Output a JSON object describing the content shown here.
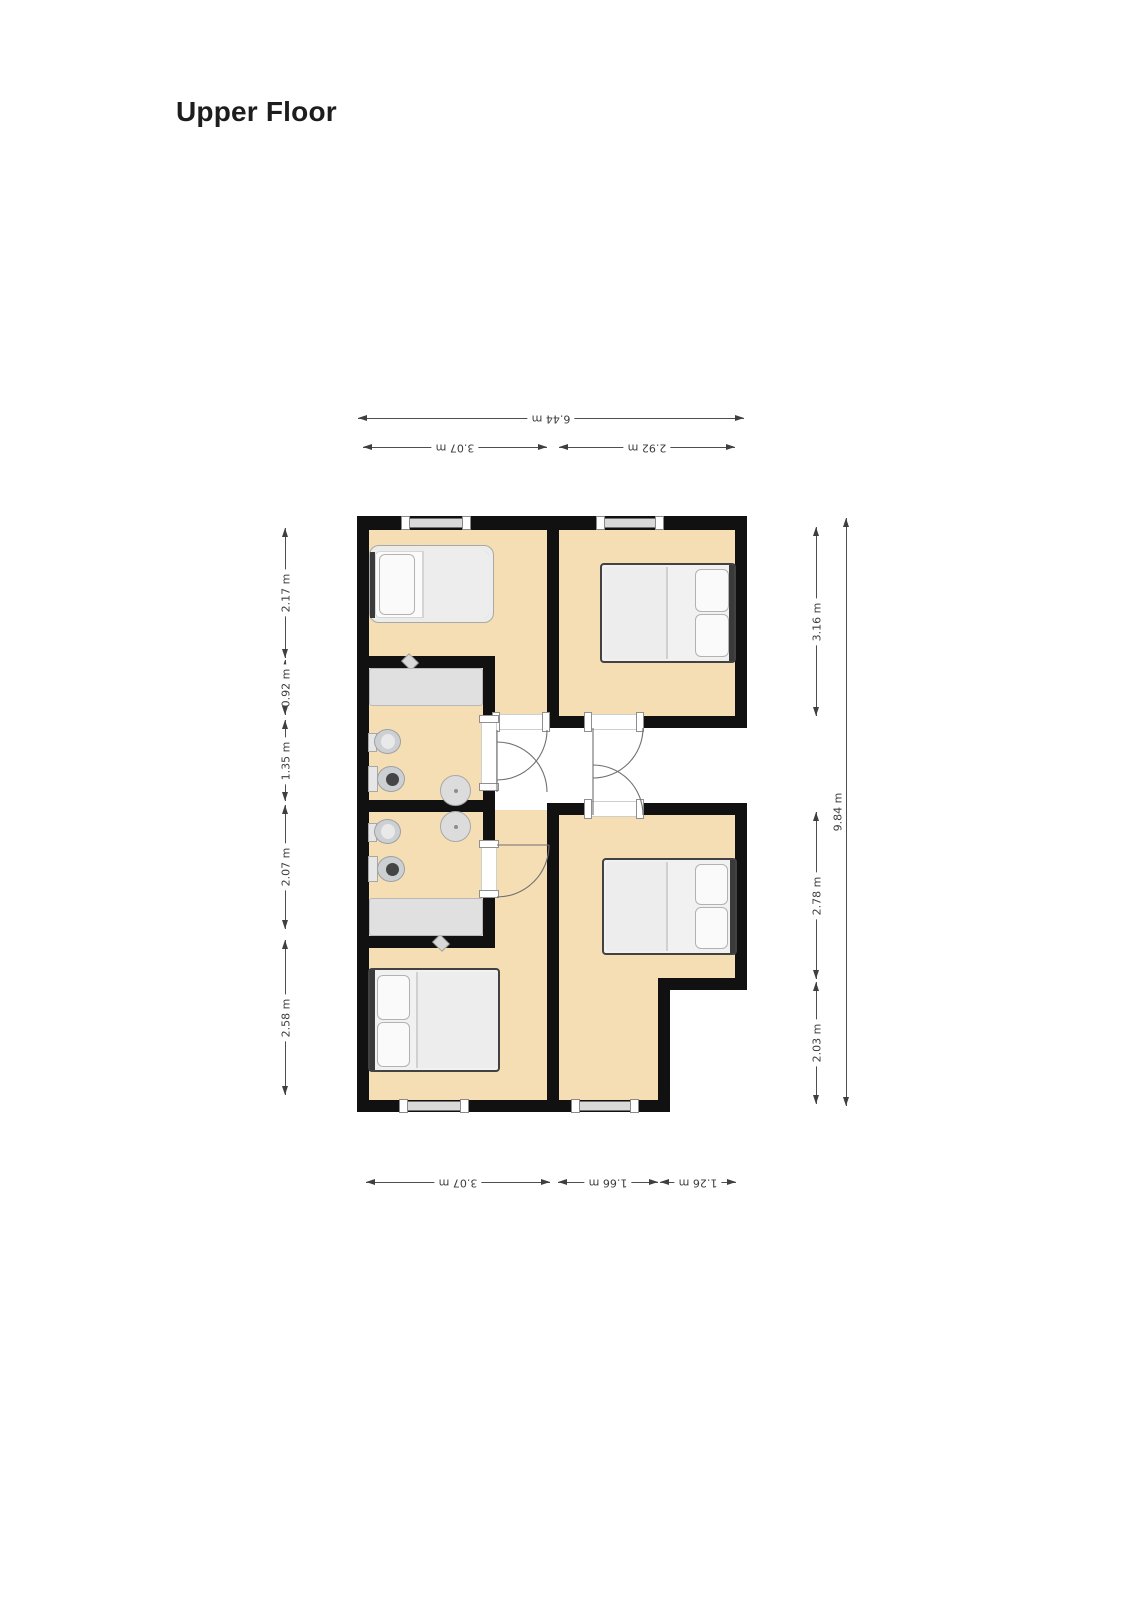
{
  "title": "Upper Floor",
  "floorplan": {
    "colors": {
      "wall": "#111111",
      "floor": "#f5ddb4",
      "landing": "#ffffff",
      "dimension_text": "#3c3c3c"
    },
    "dimensions": {
      "top": [
        {
          "label": "6.44 m"
        },
        {
          "label": "3.07 m"
        },
        {
          "label": "2.92 m"
        }
      ],
      "bottom": [
        {
          "label": "3.07 m"
        },
        {
          "label": "1.66 m"
        },
        {
          "label": "1.26 m"
        }
      ],
      "left": [
        {
          "label": "2.17 m"
        },
        {
          "label": "0.92 m"
        },
        {
          "label": "1.35 m"
        },
        {
          "label": "2.07 m"
        },
        {
          "label": "2.58 m"
        }
      ],
      "right": [
        {
          "label": "3.16 m"
        },
        {
          "label": "2.78 m"
        },
        {
          "label": "2.03 m"
        },
        {
          "label": "9.84 m"
        }
      ]
    },
    "rooms": [
      {
        "name": "bedroom-top-left",
        "furniture": [
          "single-bed"
        ]
      },
      {
        "name": "bedroom-top-right",
        "furniture": [
          "double-bed"
        ]
      },
      {
        "name": "bathroom-upper",
        "furniture": [
          "counter",
          "bidet",
          "toilet",
          "round-sink"
        ]
      },
      {
        "name": "bathroom-lower",
        "furniture": [
          "bidet",
          "toilet",
          "round-sink",
          "counter"
        ]
      },
      {
        "name": "landing",
        "furniture": []
      },
      {
        "name": "bedroom-bottom-left",
        "furniture": [
          "double-bed"
        ]
      },
      {
        "name": "bedroom-bottom-right",
        "furniture": [
          "double-bed"
        ]
      }
    ]
  }
}
